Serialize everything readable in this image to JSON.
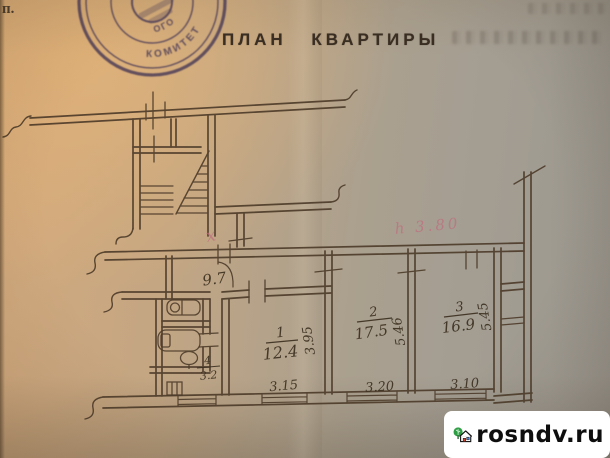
{
  "header": {
    "corner_mark": "п.",
    "title": "ПЛАН  КВАРТИРЫ"
  },
  "stamp": {
    "shape": "round-seal",
    "fragments": [
      "КОМИТЕТ",
      "ОГО"
    ]
  },
  "plan": {
    "corridor_area_label": "9.7",
    "rooms": [
      {
        "name": "room-1",
        "number": "1",
        "area_label": "12.4",
        "width_label": "3.15",
        "depth_label": "3.95"
      },
      {
        "name": "room-2",
        "number": "2",
        "area_label": "17.5",
        "width_label": "3.20",
        "depth_label": "5.46"
      },
      {
        "name": "room-3",
        "number": "3",
        "area_label": "16.9",
        "width_label": "3.10",
        "depth_label": "5.45"
      },
      {
        "name": "bathroom",
        "number": "4",
        "area_label": "3.2"
      }
    ],
    "pink_annotations": {
      "mark": "х",
      "note": "h 3.80"
    }
  },
  "watermark": {
    "text": "rosndv.ru"
  },
  "colors": {
    "paper_warm": "#cfa87c",
    "paper_gray": "#a09b91",
    "plan_ink": "#4c3a28",
    "handwriting_ink": "#3c3020",
    "stamp_ink": "#4a3b57",
    "pink_note": "#c06a7d",
    "watermark_green": "#2e9e44",
    "watermark_red": "#d2412e",
    "watermark_blue": "#4a7fd4"
  }
}
